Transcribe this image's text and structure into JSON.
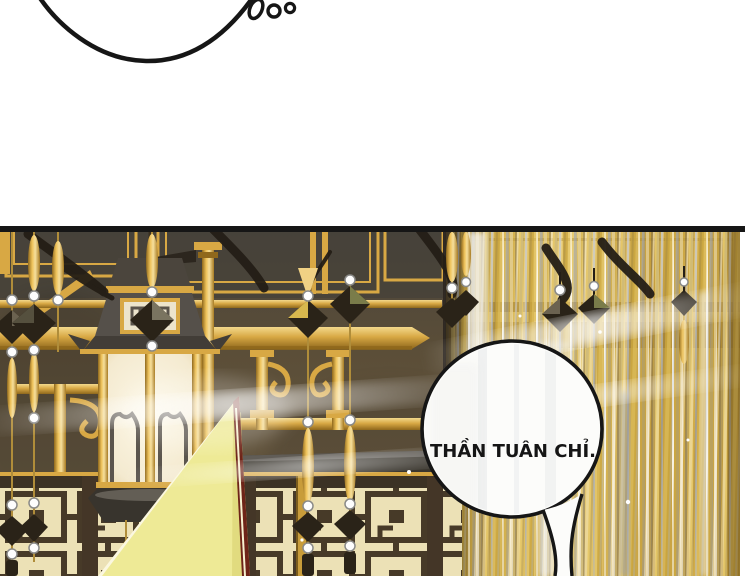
{
  "speech_bubble": {
    "text": "THẦN TUÂN CHỈ."
  },
  "palette": {
    "ink": "#161616",
    "paper": "#ffffff",
    "wall": "#564a36",
    "wall-dark": "#3f3a33",
    "gold": "#d8a844",
    "gold-bright": "#f0d184",
    "gold-deep": "#8f681c",
    "cream": "#ece1b6",
    "fret": "#473a28",
    "lantern-glow": "#faf3dc",
    "curtain-gold": "#c9a23c",
    "curtain-sheen": "#eef0f4",
    "crystal": "#2a2318",
    "pearl": "#fdfdfd",
    "flag": "#eeea96",
    "flag-edge": "#6e2418",
    "shadow-beam": "#3a362e"
  }
}
